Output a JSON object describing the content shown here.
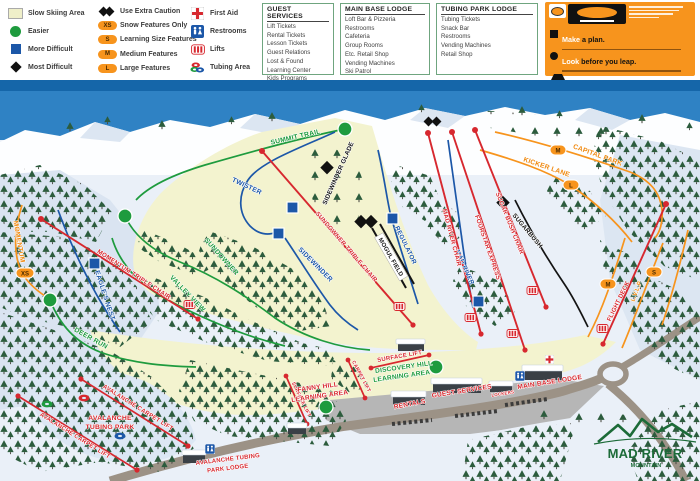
{
  "legend": {
    "items": [
      {
        "label": "Slow Skiing Area"
      },
      {
        "label": "Easier"
      },
      {
        "label": "More Difficult"
      },
      {
        "label": "Most Difficult"
      },
      {
        "label": "Use Extra Caution"
      },
      {
        "badge": "XS",
        "label": "Snow Features Only"
      },
      {
        "badge": "S",
        "label": "Learning Size Features"
      },
      {
        "badge": "M",
        "label": "Medium Features"
      },
      {
        "badge": "L",
        "label": "Large Features"
      },
      {
        "label": "First Aid"
      },
      {
        "label": "Restrooms"
      },
      {
        "label": "Lifts"
      },
      {
        "label": "Tubing Area"
      }
    ]
  },
  "info_boxes": [
    {
      "title": "GUEST SERVICES",
      "items": [
        "Lift Tickets",
        "Rental Tickets",
        "Lesson Tickets",
        "Guest Relations",
        "Lost & Found",
        "Learning Center",
        "Kids Programs"
      ]
    },
    {
      "title": "MAIN BASE LODGE",
      "items": [
        "Loft Bar & Pizzeria",
        "Restrooms",
        "Cafeteria",
        "Group Rooms",
        "Etc. Retail Shop",
        "Vending Machines",
        "Ski Patrol"
      ]
    },
    {
      "title": "TUBING PARK LODGE",
      "items": [
        "Tubing Tickets",
        "Snack Bar",
        "Restrooms",
        "Vending Machines",
        "Retail Shop"
      ]
    }
  ],
  "smart_style": {
    "items": [
      {
        "lead": "Make",
        "rest": "a plan."
      },
      {
        "lead": "Look",
        "rest": "before you leap."
      },
      {
        "lead": "Easy",
        "rest": "style it."
      },
      {
        "lead": "Respect",
        "rest": "gets respect."
      }
    ]
  },
  "map": {
    "trails": {
      "summit": "SUMMIT TRAIL",
      "sundowner": "SUNDOWNER",
      "valley_view": "VALLEY VIEW",
      "deer_run": "DEER RUN",
      "momentum": "MOMENTUM",
      "eagles_nest": "EAGLE'S NEST",
      "twister": "TWISTER",
      "sidewinder": "SIDEWINDER",
      "sidewinder_glade": "SIDEWINDER GLADE",
      "mogul_field": "MOGUL FIELD",
      "regulator": "REGULATOR",
      "mad_river": "MAD RIVER",
      "sugarbush": "SUGARBUSH",
      "capital_park": "CAPITAL PARK",
      "kicker_lane": "KICKER LANE",
      "lvlp": "L.V.L.P"
    },
    "lifts": {
      "momentum_triple": "MOMENTUM TRIPLE CHAIR",
      "sundowner_triple": "SUNDOWNER TRIPLE CHAIR",
      "mad_river_chair": "MAD RIVER CHAIR",
      "fourstar_express": "FOURSTAR EXPRESS",
      "sugar_bush_chair": "SUGAR BUSH CHAIR",
      "flight_deck": "FLIGHT DECK",
      "surface_lift": "SURFACE LIFT",
      "carpet_lift": "CARPET LIFT",
      "avalanche_carpet_lift": "AVALANCHE CARPET LIFT"
    },
    "areas": {
      "discovery_l1": "DISCOVERY HILL",
      "discovery_l2": "LEARNING AREA",
      "fanny_l1": "FANNY HILL",
      "fanny_l2": "LEARNING AREA",
      "tubing_l1": "AVALANCHE",
      "tubing_l2": "TUBING PARK",
      "lodge_l1": "AVALANCHE TUBING",
      "lodge_l2": "PARK LODGE"
    },
    "facilities": {
      "rentals": "RENTALS",
      "guest_services": "GUEST SERVICES",
      "lockers": "LOCKERS",
      "main_base_lodge": "MAIN BASE LODGE"
    },
    "badges": {
      "xs": "XS",
      "s": "S",
      "m": "M",
      "l": "L"
    },
    "logo": {
      "line1": "MAD RIVER",
      "line2": "MOUNTAIN"
    }
  },
  "colors": {
    "sky": "#2F82C4",
    "band": "#1566A9",
    "snow": "#EAF0F8",
    "slope": "#F3F3CF",
    "tree": "#2C5C3D",
    "green": "#1E9B3E",
    "blue": "#1C57A8",
    "red": "#D7282F",
    "orange": "#F7941D",
    "parking": "#B6B6B6",
    "road": "#9C9286",
    "logo_green": "#1C6B38"
  }
}
